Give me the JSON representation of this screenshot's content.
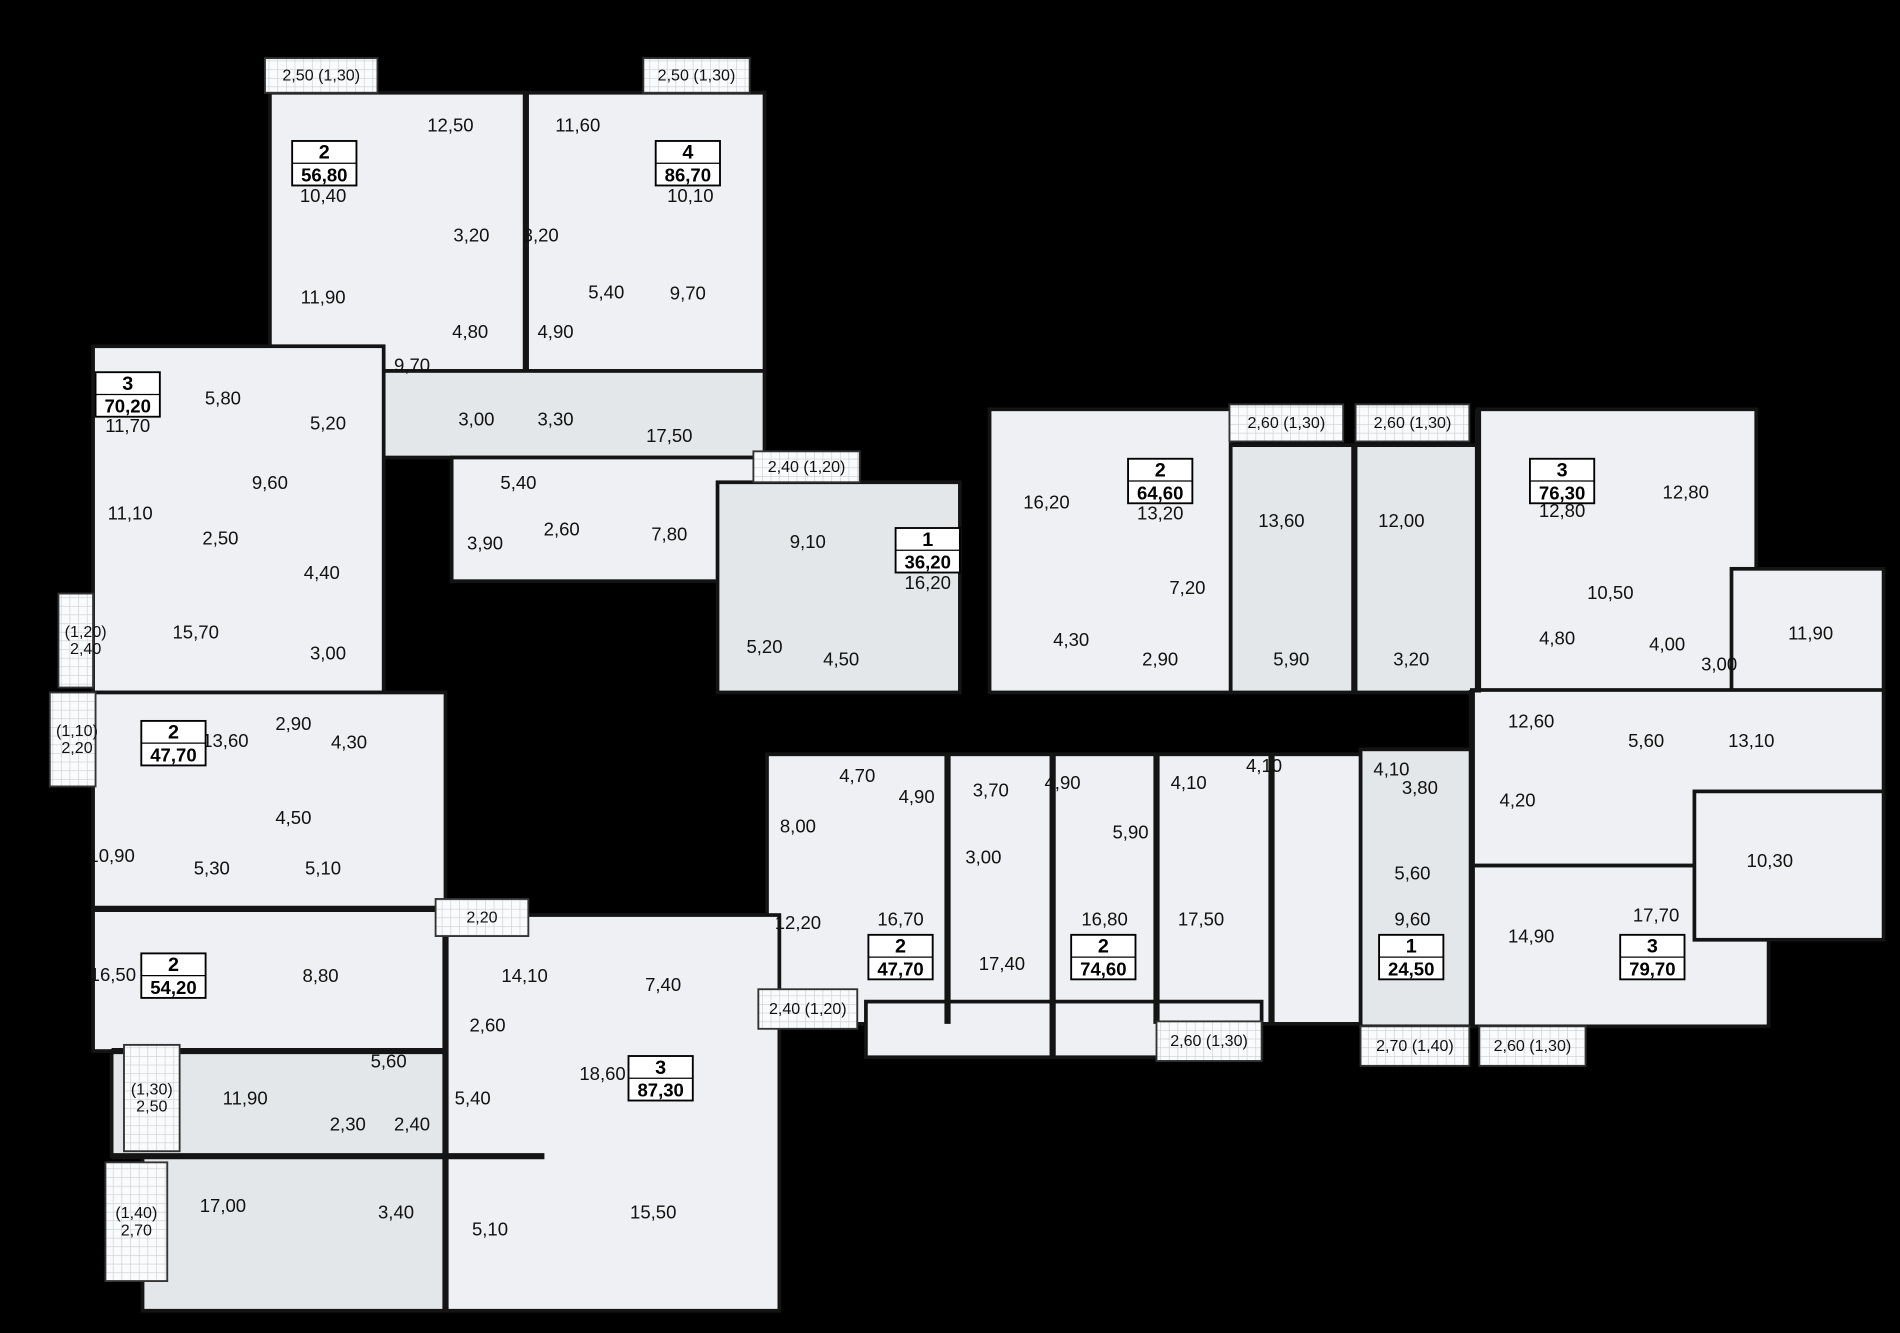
{
  "canvas": {
    "width": 1900,
    "height": 1333,
    "viewbox_w": 1536,
    "viewbox_h": 1078,
    "background": "#000000",
    "floor_fill": "#eef0f3",
    "floor_fill_shaded": "#e3e7ea",
    "balcony_fill": "#fafbfc",
    "hatch_color": "#c9ced3",
    "wall_color": "#141414",
    "text_color": "#111111"
  },
  "floor_blocks": [
    {
      "x": 218,
      "y": 75,
      "w": 400,
      "h": 225,
      "shade": 0
    },
    {
      "x": 310,
      "y": 300,
      "w": 308,
      "h": 70,
      "shade": 1
    },
    {
      "x": 365,
      "y": 370,
      "w": 253,
      "h": 100,
      "shade": 0
    },
    {
      "x": 75,
      "y": 280,
      "w": 235,
      "h": 280,
      "shade": 0
    },
    {
      "x": 580,
      "y": 390,
      "w": 196,
      "h": 170,
      "shade": 1
    },
    {
      "x": 800,
      "y": 331,
      "w": 195,
      "h": 229,
      "shade": 0
    },
    {
      "x": 995,
      "y": 360,
      "w": 200,
      "h": 200,
      "shade": 1
    },
    {
      "x": 1195,
      "y": 331,
      "w": 225,
      "h": 229,
      "shade": 0
    },
    {
      "x": 1400,
      "y": 460,
      "w": 123,
      "h": 100,
      "shade": 0
    },
    {
      "x": 1100,
      "y": 606,
      "w": 90,
      "h": 224,
      "shade": 1
    },
    {
      "x": 1190,
      "y": 558,
      "w": 333,
      "h": 142,
      "shade": 0
    },
    {
      "x": 1190,
      "y": 700,
      "w": 240,
      "h": 130,
      "shade": 0
    },
    {
      "x": 1370,
      "y": 640,
      "w": 153,
      "h": 120,
      "shade": 0
    },
    {
      "x": 620,
      "y": 610,
      "w": 480,
      "h": 218,
      "shade": 0
    },
    {
      "x": 700,
      "y": 810,
      "w": 320,
      "h": 45,
      "shade": 0
    },
    {
      "x": 75,
      "y": 560,
      "w": 285,
      "h": 175,
      "shade": 0
    },
    {
      "x": 75,
      "y": 735,
      "w": 285,
      "h": 115,
      "shade": 0
    },
    {
      "x": 90,
      "y": 850,
      "w": 270,
      "h": 85,
      "shade": 1
    },
    {
      "x": 115,
      "y": 935,
      "w": 245,
      "h": 125,
      "shade": 1
    },
    {
      "x": 360,
      "y": 740,
      "w": 270,
      "h": 320,
      "shade": 0
    }
  ],
  "walls": [
    [
      425,
      75,
      425,
      300
    ],
    [
      1095,
      360,
      1095,
      560
    ],
    [
      1195,
      331,
      1195,
      560
    ],
    [
      766,
      610,
      766,
      828
    ],
    [
      851,
      610,
      851,
      855
    ],
    [
      935,
      610,
      935,
      828
    ],
    [
      1028,
      610,
      1028,
      828
    ],
    [
      1190,
      558,
      1190,
      830
    ],
    [
      75,
      735,
      360,
      735
    ],
    [
      90,
      850,
      360,
      850
    ],
    [
      90,
      935,
      440,
      935
    ],
    [
      360,
      740,
      360,
      1060
    ]
  ],
  "balconies": [
    {
      "x": 214,
      "y": 47,
      "w": 91,
      "h": 28,
      "lines": [
        "2,50 (1,30)"
      ]
    },
    {
      "x": 520,
      "y": 47,
      "w": 86,
      "h": 28,
      "lines": [
        "2,50 (1,30)"
      ]
    },
    {
      "x": 47,
      "y": 480,
      "w": 28,
      "h": 76,
      "lines": [
        "(1,20)",
        "2,40"
      ]
    },
    {
      "x": 609,
      "y": 365,
      "w": 86,
      "h": 25,
      "lines": [
        "2,40 (1,20)"
      ]
    },
    {
      "x": 994,
      "y": 327,
      "w": 92,
      "h": 30,
      "lines": [
        "2,60 (1,30)"
      ]
    },
    {
      "x": 1096,
      "y": 327,
      "w": 92,
      "h": 30,
      "lines": [
        "2,60 (1,30)"
      ]
    },
    {
      "x": 40,
      "y": 560,
      "w": 37,
      "h": 76,
      "lines": [
        "(1,10)",
        "2,20"
      ]
    },
    {
      "x": 100,
      "y": 845,
      "w": 45,
      "h": 86,
      "lines": [
        "(1,30)",
        "2,50"
      ]
    },
    {
      "x": 85,
      "y": 940,
      "w": 50,
      "h": 96,
      "lines": [
        "(1,40)",
        "2,70"
      ]
    },
    {
      "x": 352,
      "y": 727,
      "w": 75,
      "h": 30,
      "lines": [
        "2,20"
      ]
    },
    {
      "x": 613,
      "y": 800,
      "w": 80,
      "h": 32,
      "lines": [
        "2,40 (1,20)"
      ]
    },
    {
      "x": 935,
      "y": 826,
      "w": 85,
      "h": 32,
      "lines": [
        "2,60 (1,30)"
      ]
    },
    {
      "x": 1100,
      "y": 830,
      "w": 88,
      "h": 32,
      "lines": [
        "2,70 (1,40)"
      ]
    },
    {
      "x": 1196,
      "y": 830,
      "w": 86,
      "h": 32,
      "lines": [
        "2,60 (1,30)"
      ]
    }
  ],
  "apartments": [
    {
      "rooms": "2",
      "area": "56,80",
      "badge": {
        "cx": 262,
        "y": 114
      },
      "room_labels": [
        [
          "12,50",
          364,
          101
        ],
        [
          "10,40",
          261,
          158
        ],
        [
          "3,20",
          381,
          190
        ],
        [
          "11,90",
          261,
          240
        ],
        [
          "4,80",
          380,
          268
        ],
        [
          "9,70",
          333,
          295
        ],
        [
          "3,00",
          385,
          339
        ]
      ]
    },
    {
      "rooms": "4",
      "area": "86,70",
      "badge": {
        "cx": 556,
        "y": 114
      },
      "room_labels": [
        [
          "11,60",
          467,
          101
        ],
        [
          "10,10",
          558,
          158
        ],
        [
          "3,20",
          437,
          190
        ],
        [
          "5,40",
          490,
          236
        ],
        [
          "9,70",
          556,
          237
        ],
        [
          "4,90",
          449,
          268
        ],
        [
          "3,30",
          449,
          339
        ],
        [
          "17,50",
          541,
          352
        ],
        [
          "5,40",
          419,
          390
        ],
        [
          "2,60",
          454,
          428
        ],
        [
          "3,90",
          392,
          439
        ],
        [
          "7,80",
          541,
          432
        ]
      ]
    },
    {
      "rooms": "3",
      "area": "70,20",
      "badge": {
        "cx": 103,
        "y": 301
      },
      "room_labels": [
        [
          "11,70",
          103,
          344
        ],
        [
          "5,80",
          180,
          322
        ],
        [
          "5,20",
          265,
          342
        ],
        [
          "9,60",
          218,
          390
        ],
        [
          "11,10",
          105,
          415
        ],
        [
          "2,50",
          178,
          435
        ],
        [
          "4,40",
          260,
          463
        ],
        [
          "15,70",
          158,
          511
        ],
        [
          "3,00",
          265,
          528
        ]
      ]
    },
    {
      "rooms": "1",
      "area": "36,20",
      "badge": {
        "cx": 750,
        "y": 427
      },
      "room_labels": [
        [
          "9,10",
          653,
          438
        ],
        [
          "16,20",
          750,
          471
        ],
        [
          "5,20",
          618,
          523
        ],
        [
          "4,50",
          680,
          533
        ]
      ]
    },
    {
      "rooms": "2",
      "area": "64,60",
      "badge": {
        "cx": 938,
        "y": 371
      },
      "room_labels": [
        [
          "16,20",
          846,
          406
        ],
        [
          "13,20",
          938,
          415
        ],
        [
          "13,60",
          1036,
          421
        ],
        [
          "7,20",
          960,
          475
        ],
        [
          "4,30",
          866,
          517
        ],
        [
          "2,90",
          938,
          533
        ],
        [
          "5,90",
          1044,
          533
        ]
      ]
    },
    {
      "rooms": "3",
      "area": "76,30",
      "badge": {
        "cx": 1263,
        "y": 371
      },
      "room_labels": [
        [
          "12,00",
          1133,
          421
        ],
        [
          "12,80",
          1263,
          413
        ],
        [
          "12,80",
          1363,
          398
        ],
        [
          "10,50",
          1302,
          479
        ],
        [
          "4,80",
          1259,
          516
        ],
        [
          "4,00",
          1348,
          521
        ],
        [
          "3,00",
          1390,
          537
        ],
        [
          "3,20",
          1141,
          533
        ],
        [
          "11,90",
          1464,
          512
        ]
      ]
    },
    {
      "rooms": "2",
      "area": "47,70",
      "badge": {
        "cx": 140,
        "y": 583
      },
      "room_labels": [
        [
          "13,60",
          182,
          599
        ],
        [
          "2,90",
          237,
          585
        ],
        [
          "4,30",
          282,
          600
        ],
        [
          "4,50",
          237,
          661
        ],
        [
          "10,90",
          90,
          692
        ],
        [
          "5,30",
          171,
          702
        ],
        [
          "5,10",
          261,
          702
        ]
      ]
    },
    {
      "rooms": "2",
      "area": "54,20",
      "badge": {
        "cx": 140,
        "y": 771
      },
      "room_labels": [
        [
          "16,50",
          91,
          788
        ],
        [
          "8,80",
          259,
          789
        ],
        [
          "11,90",
          198,
          888
        ],
        [
          "5,60",
          314,
          858
        ],
        [
          "2,30",
          281,
          909
        ],
        [
          "2,40",
          333,
          909
        ]
      ]
    },
    {
      "rooms": "3",
      "area": "87,30",
      "badge": {
        "cx": 534,
        "y": 854
      },
      "room_labels": [
        [
          "17,00",
          180,
          975
        ],
        [
          "3,40",
          320,
          980
        ],
        [
          "5,10",
          396,
          994
        ],
        [
          "14,10",
          424,
          789
        ],
        [
          "7,40",
          536,
          796
        ],
        [
          "2,60",
          394,
          829
        ],
        [
          "5,40",
          382,
          888
        ],
        [
          "18,60",
          487,
          868
        ],
        [
          "15,50",
          528,
          980
        ]
      ]
    },
    {
      "rooms": "2",
      "area": "47,70",
      "badge": {
        "cx": 728,
        "y": 756
      },
      "room_labels": [
        [
          "4,70",
          693,
          627
        ],
        [
          "8,00",
          645,
          668
        ],
        [
          "4,90",
          741,
          644
        ],
        [
          "3,00",
          795,
          693
        ],
        [
          "12,20",
          645,
          746
        ],
        [
          "16,70",
          728,
          743
        ]
      ]
    },
    {
      "rooms": "2",
      "area": "74,60",
      "badge": {
        "cx": 892,
        "y": 756
      },
      "room_labels": [
        [
          "3,70",
          801,
          639
        ],
        [
          "4,90",
          859,
          633
        ],
        [
          "5,90",
          914,
          673
        ],
        [
          "4,10",
          961,
          633
        ],
        [
          "4,10",
          1022,
          619
        ],
        [
          "17,40",
          810,
          779
        ],
        [
          "16,80",
          893,
          743
        ],
        [
          "17,50",
          971,
          743
        ]
      ]
    },
    {
      "rooms": "1",
      "area": "24,50",
      "badge": {
        "cx": 1141,
        "y": 756
      },
      "room_labels": [
        [
          "4,10",
          1125,
          622
        ],
        [
          "3,80",
          1148,
          637
        ],
        [
          "5,60",
          1142,
          706
        ],
        [
          "9,60",
          1142,
          743
        ]
      ]
    },
    {
      "rooms": "3",
      "area": "79,70",
      "badge": {
        "cx": 1336,
        "y": 756
      },
      "room_labels": [
        [
          "12,60",
          1238,
          583
        ],
        [
          "5,60",
          1331,
          599
        ],
        [
          "4,20",
          1227,
          647
        ],
        [
          "13,10",
          1416,
          599
        ],
        [
          "10,30",
          1431,
          696
        ],
        [
          "14,90",
          1238,
          757
        ],
        [
          "17,70",
          1339,
          740
        ]
      ]
    }
  ],
  "badge_style": {
    "w": 52,
    "h": 36,
    "divider_y": 18
  }
}
